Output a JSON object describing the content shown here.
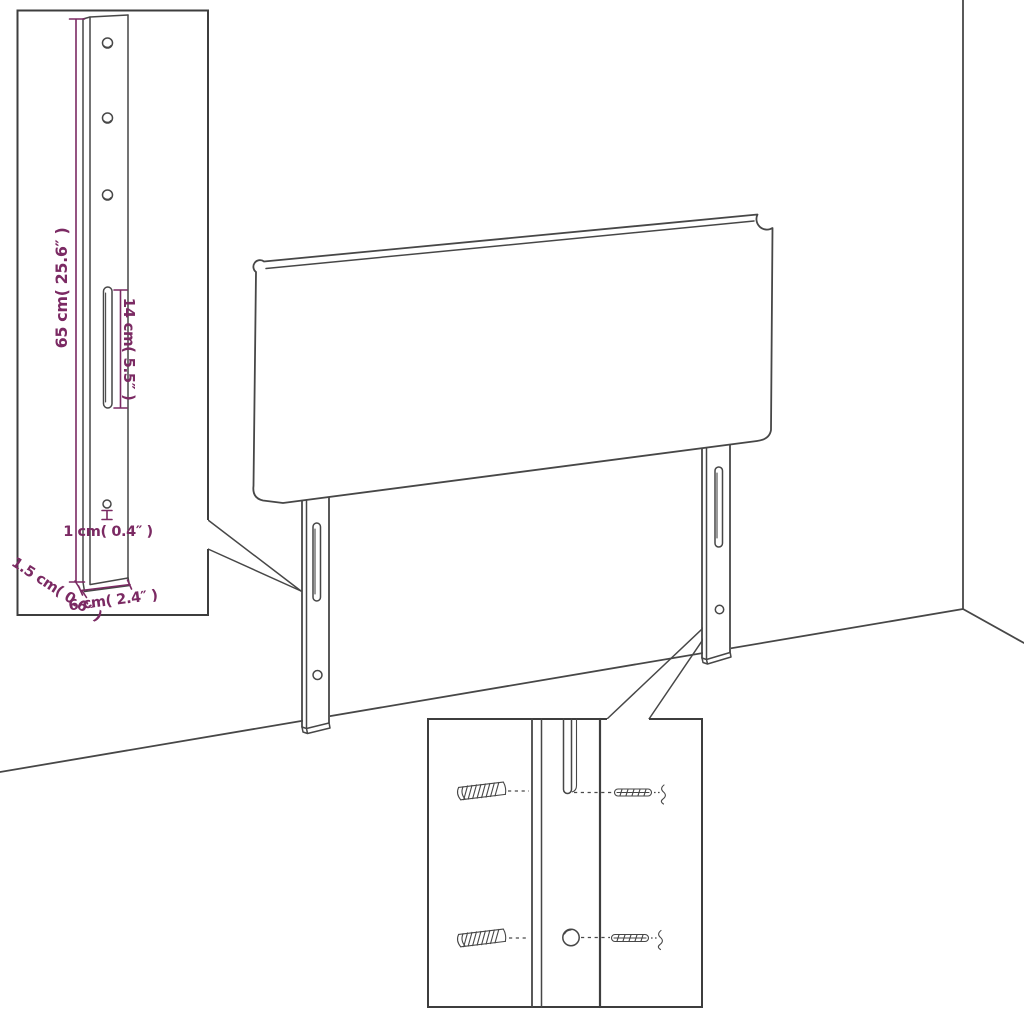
{
  "scene": {
    "description": "Line-art assembly diagram of an upholstered headboard with two mounting legs standing in a room corner, with two magnified detail insets",
    "background_color": "#ffffff",
    "line_color": "#474747",
    "dimension_color": "#7b2a63"
  },
  "bracket_inset": {
    "dim_height": "65 cm( 25.6″ )",
    "dim_slot_length": "14 cm( 5.5″ )",
    "dim_hole_diameter": "1 cm( 0.4″ )",
    "dim_thickness": "1.5 cm( 0.6″ )",
    "dim_width": "6 cm( 2.4″ )"
  },
  "hardware_inset": {
    "left_items": "wall-plug",
    "right_items": "screw"
  }
}
